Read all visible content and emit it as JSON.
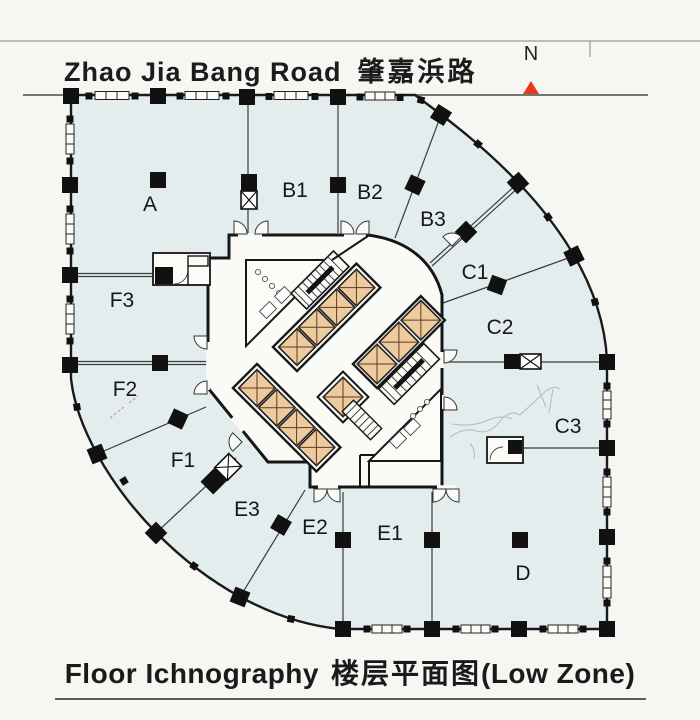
{
  "header": {
    "road_name_en": "Zhao Jia Bang Road",
    "road_name_zh": "肇嘉浜路",
    "compass_label": "N"
  },
  "footer": {
    "title_en": "Floor Ichnography",
    "title_zh": "楼层平面图",
    "zone_note": "(Low Zone)"
  },
  "plan": {
    "zone_labels": {
      "a": "A",
      "b1": "B1",
      "b2": "B2",
      "b3": "B3",
      "c1": "C1",
      "c2": "C2",
      "c3": "C3",
      "d": "D",
      "e1": "E1",
      "e2": "E2",
      "e3": "E3",
      "f1": "F1",
      "f2": "F2",
      "f3": "F3"
    }
  },
  "colors": {
    "paper": "#f6f6f3",
    "floor": "#e3edee",
    "corridor": "#fafaf7",
    "wall": "#1a1a1a",
    "elevator_cab": "#eeca9f",
    "north_arrow": "#e8391a"
  }
}
